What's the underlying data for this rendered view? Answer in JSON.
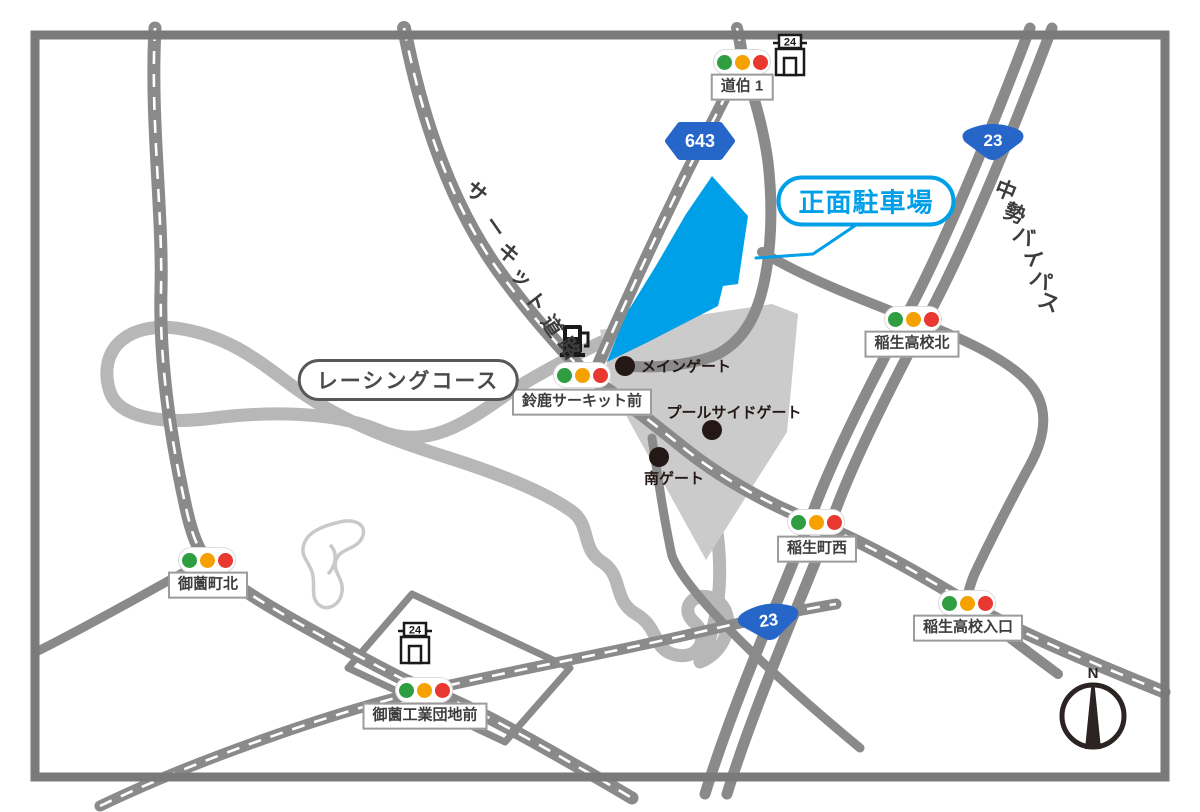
{
  "map": {
    "parking": {
      "callout_label": "正面駐車場",
      "accent_color": "#00a0e9"
    },
    "racing_course": {
      "label": "レーシングコース"
    },
    "road_names": {
      "circuit_road": "サーキット道路",
      "chusei_bypass": "中勢バイパス"
    },
    "route_shields": {
      "prefectural_643": "643",
      "national_23_north": "23",
      "national_23_south": "23"
    },
    "intersections": [
      {
        "name": "道伯 1"
      },
      {
        "name": "鈴鹿サーキット前"
      },
      {
        "name": "稲生高校北"
      },
      {
        "name": "稲生町西"
      },
      {
        "name": "稲生高校入口"
      },
      {
        "name": "御薗町北"
      },
      {
        "name": "御薗工業団地前"
      }
    ],
    "gates": [
      {
        "name": "メインゲート"
      },
      {
        "name": "プールサイドゲート"
      },
      {
        "name": "南ゲート"
      }
    ],
    "stores": [
      {
        "badge": "24"
      },
      {
        "badge": "24"
      }
    ],
    "compass": {
      "north_label": "N"
    },
    "colors": {
      "road": "#8a8a8a",
      "track": "#b7b7b7",
      "grounds": "#cbcbcb",
      "parking_blue": "#00a0e9",
      "shield_blue": "#2566c8",
      "signal_green": "#2f9e41",
      "signal_yellow": "#f5a200",
      "signal_red": "#e8382f"
    }
  }
}
